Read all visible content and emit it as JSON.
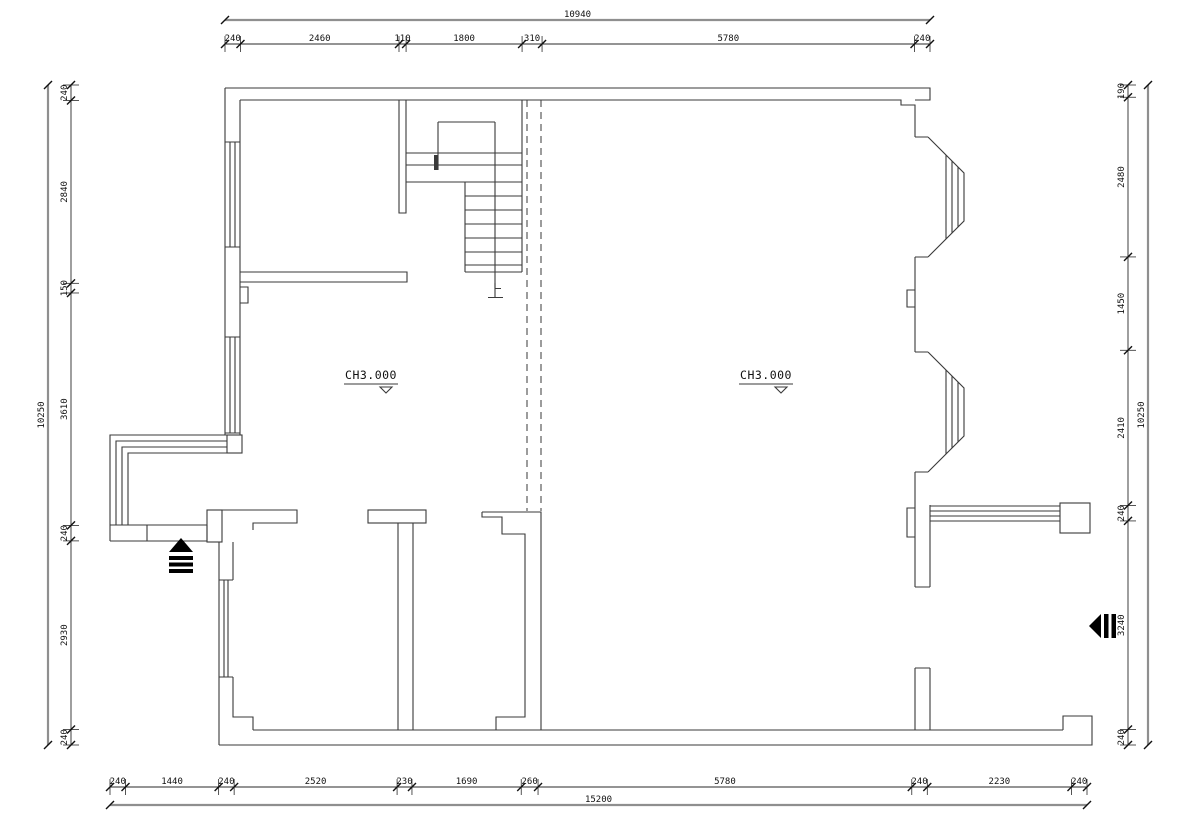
{
  "drawing": {
    "floor_labels": [
      {
        "text": "CH3.000"
      },
      {
        "text": "CH3.000"
      }
    ],
    "stair_direction_label": "上"
  },
  "dims": {
    "top": {
      "overall": "10940",
      "segments": [
        "240",
        "2460",
        "110",
        "1800",
        "310",
        "5780",
        "240"
      ]
    },
    "bottom": {
      "overall": "15200",
      "segments": [
        "240",
        "1440",
        "240",
        "2520",
        "230",
        "1690",
        "260",
        "5780",
        "240",
        "2230",
        "240"
      ]
    },
    "left": {
      "overall": "10250",
      "segments": [
        "240",
        "2840",
        "150",
        "3610",
        "240",
        "2930",
        "240"
      ]
    },
    "right": {
      "overall": "10250",
      "segments": [
        "190",
        "2480",
        "1450",
        "2410",
        "240",
        "3240",
        "240"
      ]
    }
  },
  "colors": {
    "background": "#ffffff",
    "line": "#3a3a3a",
    "dim_line": "#2a2a2a",
    "overall_line": "#8f8f8f",
    "text": "#111111",
    "arrow_fill": "#000000"
  }
}
